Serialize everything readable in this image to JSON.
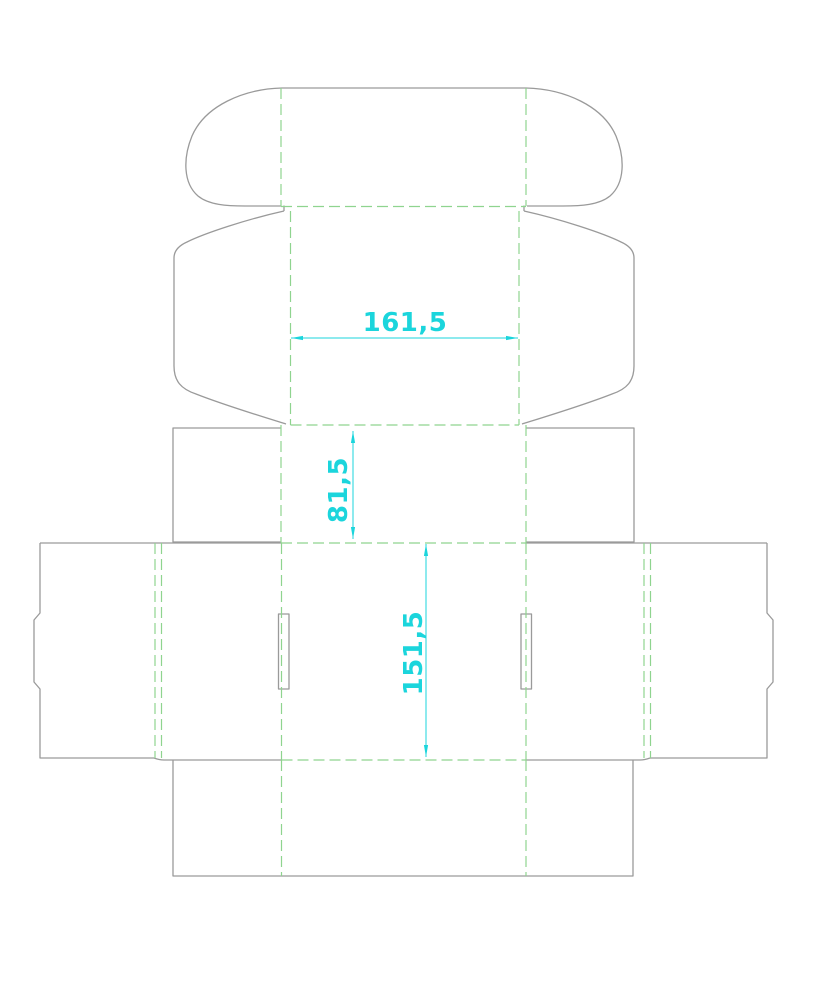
{
  "drawing": {
    "type": "packaging-dieline",
    "background": "#ffffff",
    "canvas": {
      "width": 814,
      "height": 1000
    },
    "colors": {
      "cut": "#9a9a9a",
      "fold": "#8fd48f",
      "dimension": "#1bd5dc"
    },
    "stroke": {
      "cut_width": 1.3,
      "fold_width": 1.2,
      "dim_width": 1,
      "fold_dash": "11 5"
    },
    "dimension_font_size": 26,
    "arrow": {
      "length": 12,
      "half_width": 2.1
    }
  },
  "geometry": {
    "cuts": [
      {
        "name": "tuck-flap-top-edge",
        "d": "M282,88 L526,88"
      },
      {
        "name": "tuck-flap-ear-left",
        "d": "M282,88 C243,89 205,106 192,136 C183,158 183,183 198,196 C209,205 227,206 245,206 L281,206"
      },
      {
        "name": "tuck-flap-ear-right",
        "d": "M526,88 C565,89 603,106 616,136 C625,158 625,183 610,196 C599,205 581,206 563,206 L527,206"
      },
      {
        "name": "lid-wing-left-step",
        "d": "M284,205.5 L284,211"
      },
      {
        "name": "lid-wing-left",
        "d": "M284,211 C248,219 205,233 187,242 C178,246 174,251 174,258 L174,366 C174,381 181,389 196,394 C224,405 257,415 286,424"
      },
      {
        "name": "lid-wing-right-step",
        "d": "M524,205.5 L524,211"
      },
      {
        "name": "lid-wing-right",
        "d": "M524,211 C560,219 603,233 621,242 C630,246 634,251 634,258 L634,366 C634,381 627,389 612,394 C584,405 551,415 522,424"
      },
      {
        "name": "dust-flap-left",
        "d": "M281,428 L173,428 L173,542 L281,542"
      },
      {
        "name": "dust-flap-right",
        "d": "M526,428 L634,428 L634,542 L526,542"
      },
      {
        "name": "body-top-edge-left",
        "d": "M40,543 L281,543"
      },
      {
        "name": "body-top-edge-right",
        "d": "M526,543 L767,543"
      },
      {
        "name": "lock-flap-left",
        "d": "M40,543 L40,613 L34,620 L34,682 L40,689 L40,758 L154,758"
      },
      {
        "name": "lock-flap-right",
        "d": "M767,543 L767,613 L773,620 L773,682 L767,689 L767,758 L650,758"
      },
      {
        "name": "body-bottom-edge-left",
        "d": "M154,758 C158,759.5 160,760 164,760 L281,760"
      },
      {
        "name": "body-bottom-edge-right",
        "d": "M650,758 C646,759.5 644,760 640,760 L526,760"
      },
      {
        "name": "lock-slot-left",
        "d": "M278.5,614 L289,614 L289,689 L278.5,689 Z"
      },
      {
        "name": "lock-slot-right",
        "d": "M521,614 L531.5,614 L531.5,689 L521,689 Z"
      },
      {
        "name": "bottom-panel",
        "d": "M173,760 L173,876 L633,876 L633,760"
      }
    ],
    "folds": [
      {
        "name": "fold-tuck-left",
        "d": "M281,88 L281,206"
      },
      {
        "name": "fold-tuck-right",
        "d": "M526,88 L526,206"
      },
      {
        "name": "fold-tuck-bottom",
        "d": "M281,206.5 L526,206.5"
      },
      {
        "name": "fold-lid-left",
        "d": "M290.5,211 L290.5,425"
      },
      {
        "name": "fold-lid-right",
        "d": "M519,211 L519,425"
      },
      {
        "name": "fold-lid-bottom",
        "d": "M290.5,425 L519,425"
      },
      {
        "name": "fold-dust-left",
        "d": "M281,425 L281,543"
      },
      {
        "name": "fold-dust-right",
        "d": "M526,425 L526,543"
      },
      {
        "name": "fold-body-top",
        "d": "M281,543 L526,543"
      },
      {
        "name": "fold-body-left",
        "d": "M281.5,543 L281.5,760"
      },
      {
        "name": "fold-body-right",
        "d": "M526,543 L526,760"
      },
      {
        "name": "fold-lock-left-outer",
        "d": "M155,543 L155,758"
      },
      {
        "name": "fold-lock-left-inner",
        "d": "M161.5,543 L161.5,758"
      },
      {
        "name": "fold-lock-right-inner",
        "d": "M644,543 L644,758"
      },
      {
        "name": "fold-lock-right-outer",
        "d": "M650.5,543 L650.5,758"
      },
      {
        "name": "fold-bottom-top",
        "d": "M281.5,760 L526,760"
      },
      {
        "name": "fold-bottom-left",
        "d": "M281.5,760 L281.5,876"
      },
      {
        "name": "fold-bottom-right",
        "d": "M526,760 L526,876"
      }
    ],
    "dimensions": [
      {
        "name": "dimension-lid-width",
        "label": "161,5",
        "x1": 291,
        "y1": 338,
        "x2": 518,
        "y2": 338,
        "tx": 405,
        "ty": 331,
        "rotate": 0
      },
      {
        "name": "dimension-dust-height",
        "label": "81,5",
        "x1": 353,
        "y1": 431,
        "x2": 353,
        "y2": 539,
        "tx": 347,
        "ty": 490,
        "rotate": -90
      },
      {
        "name": "dimension-body-height",
        "label": "151,5",
        "x1": 426,
        "y1": 544,
        "x2": 426,
        "y2": 757,
        "tx": 422,
        "ty": 653,
        "rotate": -90
      }
    ]
  }
}
